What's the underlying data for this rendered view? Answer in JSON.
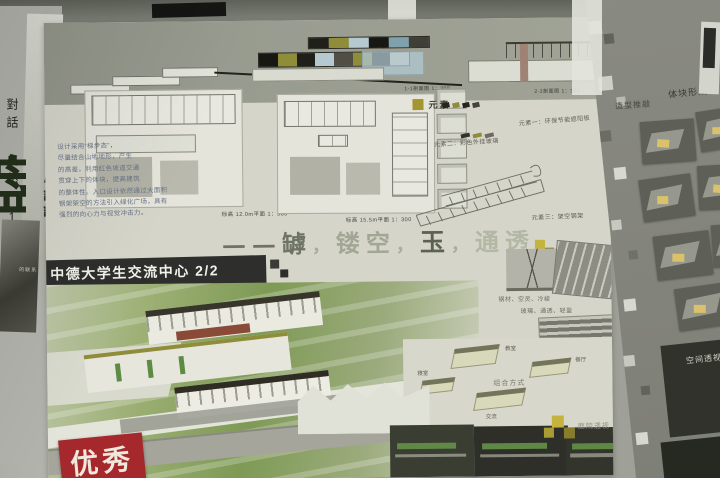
{
  "left_panel": {
    "banner_title": "中德文化交流中心設計",
    "banner_side": "對話 自然 1",
    "glyph_fragment": "盘",
    "photo_caption": "的联系"
  },
  "board": {
    "title": "中德大学生交流中心 2/2",
    "sections": {
      "caption_left": "1-1剖面图 1：300",
      "caption_right": "2-2剖面图 1：300"
    },
    "plans": {
      "caption_left": "标高 12.0m平面 1：300",
      "caption_right": "标高 15.5m平面 1：300"
    },
    "design_note": "设计采用“梯步态”，\n尽量结合山地地形，产生\n的高差，利用红色坡道交通\n贯穿上下的体块，提高建筑\n的整体性。入口设计依然通过大面积\n钢架架空的方法引入绿化广场，具有\n强烈的向心力与视觉冲击力。",
    "calligraphy": {
      "segments": [
        "——罅",
        "，",
        "镂空",
        "，",
        "玉",
        "，",
        "通透"
      ]
    },
    "elements": {
      "group_label": "元素",
      "item1": "元素一：环保节能遮阳板",
      "item2": "元素二：彩色外挂玻璃",
      "item3": "元素三：架空钢架"
    },
    "materials": {
      "label": "对话材质",
      "line1": "钢材、空灵、冷峻",
      "line2": "玻璃、通透、轻盈"
    },
    "combo": {
      "label": "组合方式",
      "units": [
        {
          "label": "寝室"
        },
        {
          "label": "教室"
        },
        {
          "label": "餐厅"
        },
        {
          "label": "交流"
        }
      ]
    },
    "captions": {
      "courtyard": "庭院透视",
      "stamp": "优秀"
    }
  },
  "right_board": {
    "label_massing": "体块形成",
    "label_form": "造型推敲",
    "label_space": "空间透视"
  },
  "palette": {
    "board": "#d6d5ca",
    "band": "#9b9e90",
    "title_bar": "#2e2e2c",
    "accent_olive": "#a3952f",
    "accent_yellow": "#c4b43f",
    "stamp_red": "#a5292c",
    "lawn_green": "#7e9a55",
    "wall": "#9fa198",
    "right_board": "#85867e",
    "dark_photo": "#30322b"
  }
}
